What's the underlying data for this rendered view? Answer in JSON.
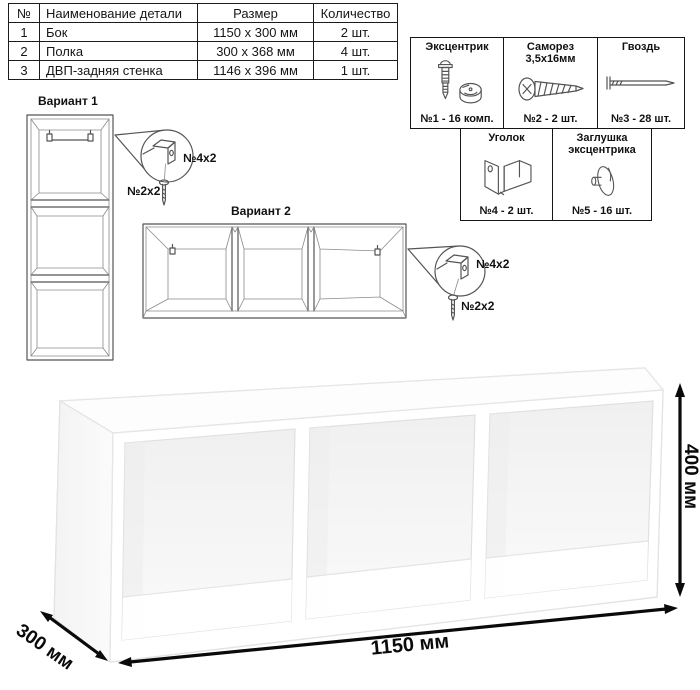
{
  "parts_table": {
    "headers": [
      "№",
      "Наименование детали",
      "Размер",
      "Количество"
    ],
    "rows": [
      [
        "1",
        "Бок",
        "1150 х 300 мм",
        "2 шт."
      ],
      [
        "2",
        "Полка",
        "300 х 368 мм",
        "4 шт."
      ],
      [
        "3",
        "ДВП-задняя стенка",
        "1146 х 396 мм",
        "1 шт."
      ]
    ]
  },
  "hardware": {
    "items": [
      {
        "name": "Эксцентрик",
        "count": "№1 - 16 комп.",
        "icon": "cam-lock-icon"
      },
      {
        "name": "Саморез 3,5х16мм",
        "count": "№2 - 2 шт.",
        "icon": "screw-icon"
      },
      {
        "name": "Гвоздь",
        "count": "№3 - 28 шт.",
        "icon": "nail-icon"
      },
      {
        "name": "Уголок",
        "count": "№4 - 2 шт.",
        "icon": "corner-bracket-icon"
      },
      {
        "name": "Заглушка эксцентрика",
        "count": "№5 - 16 шт.",
        "icon": "cam-cap-icon"
      }
    ]
  },
  "variants": {
    "v1": {
      "title": "Вариант 1",
      "bracket_label": "№4х2",
      "screw_label": "№2х2"
    },
    "v2": {
      "title": "Вариант 2",
      "bracket_label": "№4х2",
      "screw_label": "№2х2"
    }
  },
  "dimensions": {
    "width": "1150 мм",
    "height": "400 мм",
    "depth": "300 мм"
  },
  "colors": {
    "line": "#555555",
    "text": "#111111",
    "dimension": "#0a0a0a",
    "shelf_edge": "#e2e2e2",
    "shelf_face": "#ffffff",
    "interior": "#f2f2f2"
  }
}
